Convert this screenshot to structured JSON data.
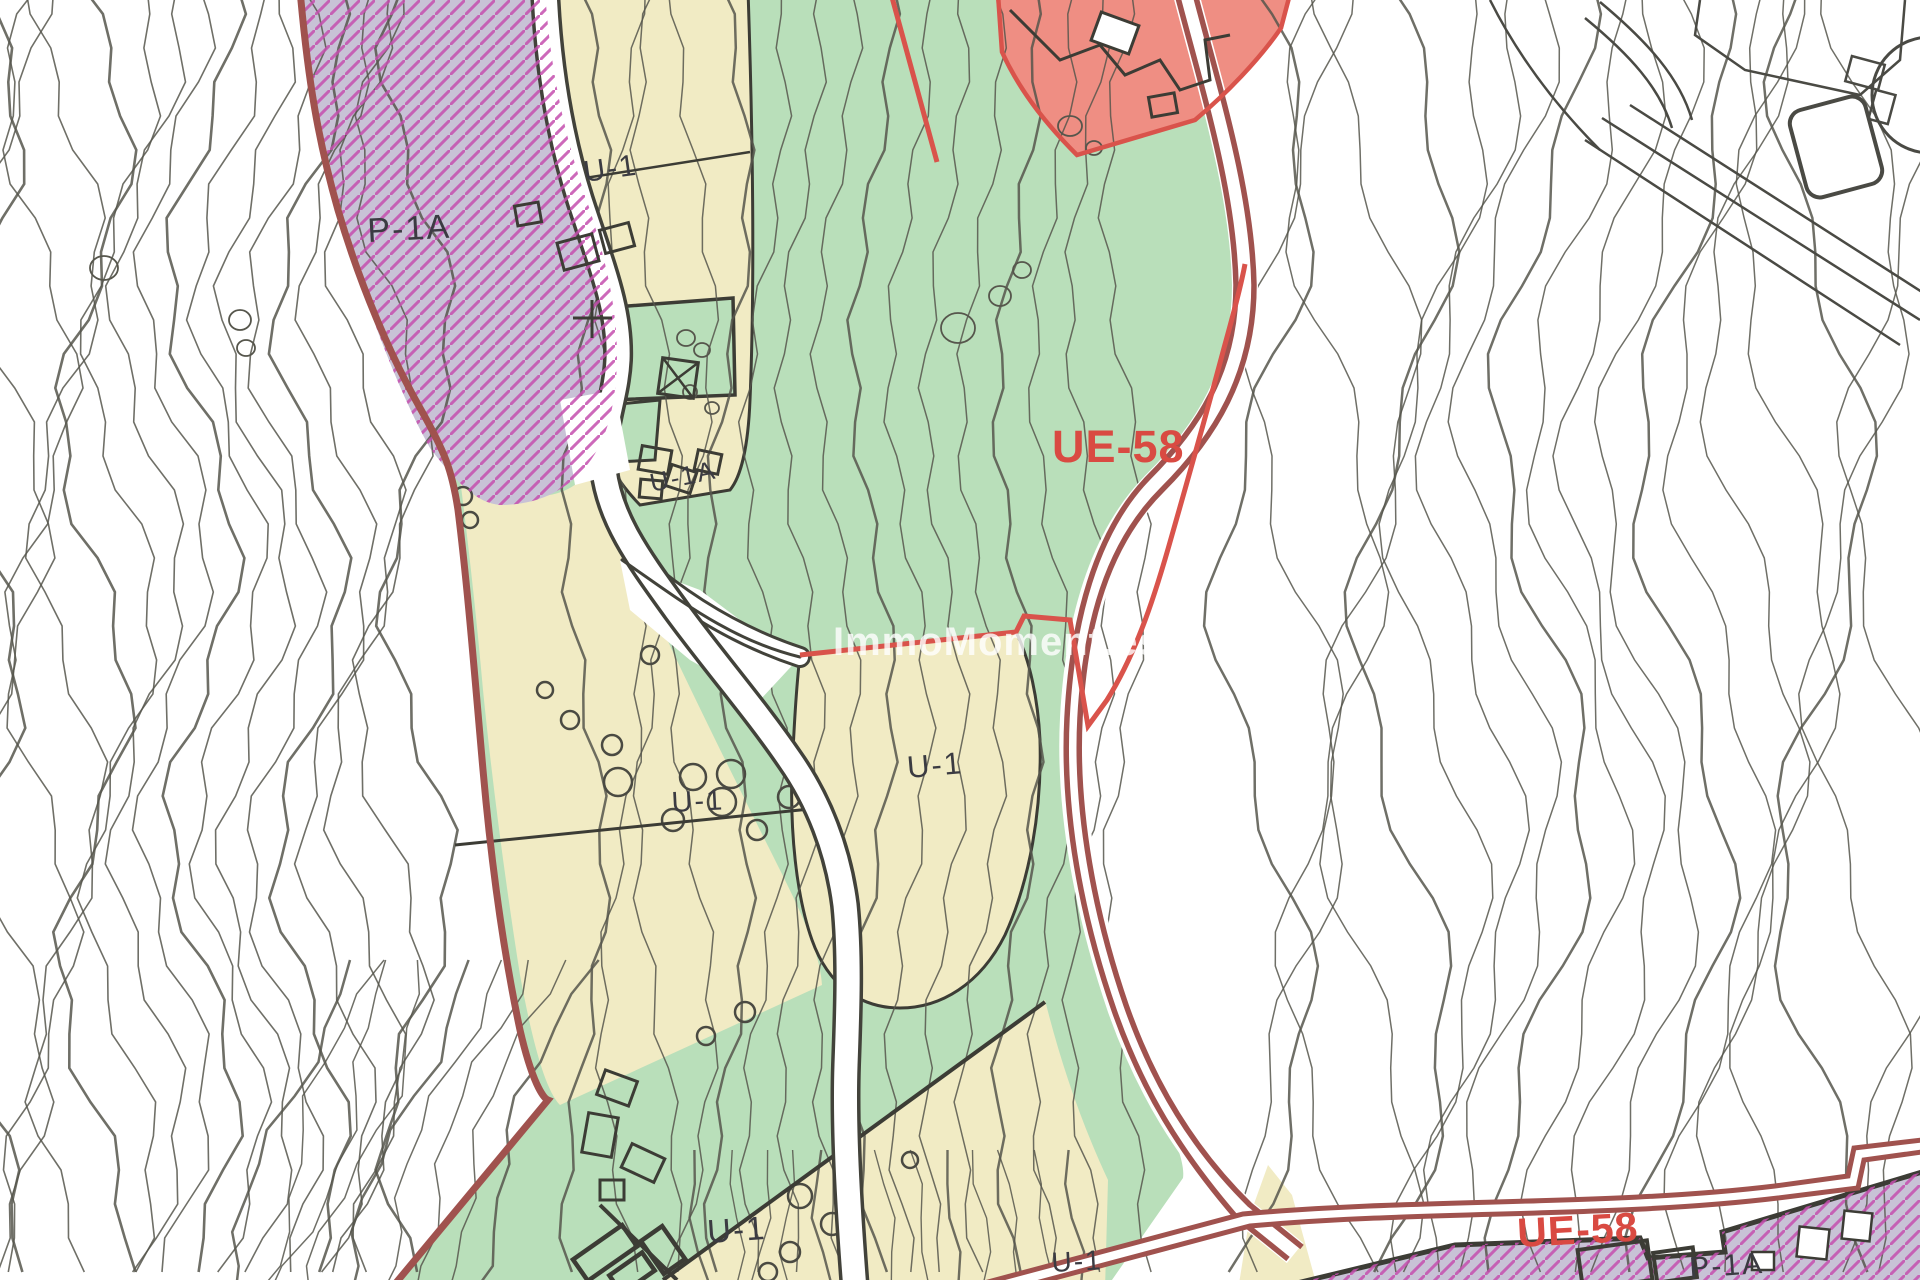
{
  "map": {
    "watermark": "ImmoMoment.es",
    "labels": {
      "p1a_top": "P-1A",
      "u1_top": "U-1",
      "u1a_mid": "U-1A",
      "ue58_main": "UE-58",
      "u1_left": "U-1",
      "u1_center": "U-1",
      "u1_bottom": "U-1",
      "u1_bottom_right": "U-1",
      "ue58_bottom": "UE-58",
      "p1a_bottom": "P-1A"
    },
    "zone_codes": [
      {
        "code": "UE-58",
        "style": "red-label",
        "occurrences": 2
      },
      {
        "code": "U-1",
        "style": "dark-label",
        "occurrences": 5
      },
      {
        "code": "U-1A",
        "style": "dark-label",
        "occurrences": 1
      },
      {
        "code": "P-1A",
        "style": "dark-label",
        "occurrences": 2
      }
    ],
    "colors": {
      "background": "#ffffff",
      "contour": "#56564c",
      "green_zone": "#b9dfba",
      "yellow_zone": "#f1ebc4",
      "purple_zone": "#c8c2d6",
      "purple_hatch": "#c44fae",
      "salmon_zone": "#ef8e83",
      "dark_red_boundary": "#a0524e",
      "bright_red_boundary": "#d9534b",
      "red_label": "#d94a42",
      "dark_label": "#3b3b42",
      "road_edge": "#42423a",
      "watermark_color": "#ffffff"
    }
  }
}
